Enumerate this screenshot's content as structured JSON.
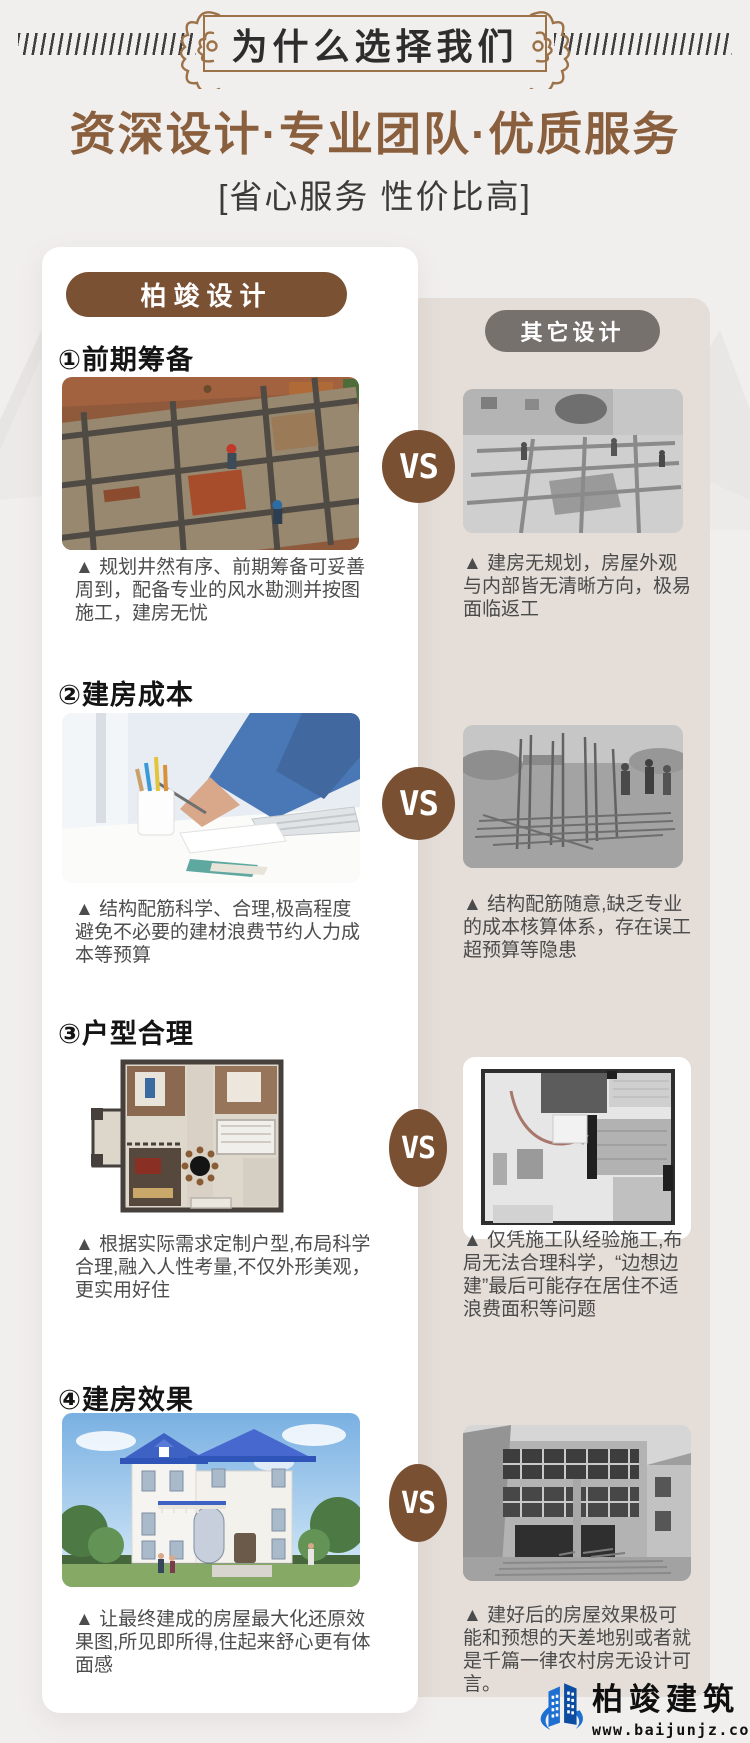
{
  "header": {
    "badge_title": "为什么选择我们",
    "main_title": "资深设计·专业团队·优质服务",
    "subtitle": "[省心服务 性价比高]"
  },
  "comparison": {
    "left_label": "柏竣设计",
    "right_label": "其它设计",
    "vs_label": "VS",
    "sections": [
      {
        "heading": "①前期筹备",
        "left_caption": "▲ 规划井然有序、前期筹备可妥善\n周到，配备专业的风水勘测并按图\n施工，建房无忧",
        "right_caption": "▲ 建房无规划，房屋外观\n与内部皆无清晰方向，极易\n面临返工",
        "left_image": "planned-foundation-site-photo",
        "right_image": "unplanned-foundation-site-photo"
      },
      {
        "heading": "②建房成本",
        "left_caption": "▲ 结构配筋科学、合理,极高程度\n避免不必要的建材浪费节约人力成\n本等预算",
        "right_caption": "▲ 结构配筋随意,缺乏专业\n的成本核算体系，存在误工\n超预算等隐患",
        "left_image": "designer-budgeting-photo",
        "right_image": "random-rebar-site-photo"
      },
      {
        "heading": "③户型合理",
        "left_caption": "▲ 根据实际需求定制户型,布局科学\n合理,融入人性考量,不仅外形美观，\n更实用好住",
        "right_caption": "▲ 仅凭施工队经验施工,布\n局无法合理科学，“边想边\n建”最后可能存在居住不适\n浪费面积等问题",
        "left_image": "custom-floorplan-image",
        "right_image": "generic-floorplan-image"
      },
      {
        "heading": "④建房效果",
        "left_caption": "▲ 让最终建成的房屋最大化还原效\n果图,所见即所得,住起来舒心更有体\n面感",
        "right_caption": "▲ 建好后的房屋效果极可\n能和预想的天差地别或者就\n是千篇一律农村房无设计可\n言。",
        "left_image": "finished-villa-render",
        "right_image": "plain-rural-house-photo"
      }
    ]
  },
  "footer_logo": {
    "company": "柏竣建筑",
    "website": "www.baijunjz.com"
  },
  "colors": {
    "page_background": "#f1efee",
    "accent_brown": "#8a5f3e",
    "pill_brown": "#7b5134",
    "pill_gray": "#77716e",
    "panel_beige": "#e5ded8",
    "vs_badge": "#7a5033",
    "logo_blue": "#1d6fd2"
  }
}
